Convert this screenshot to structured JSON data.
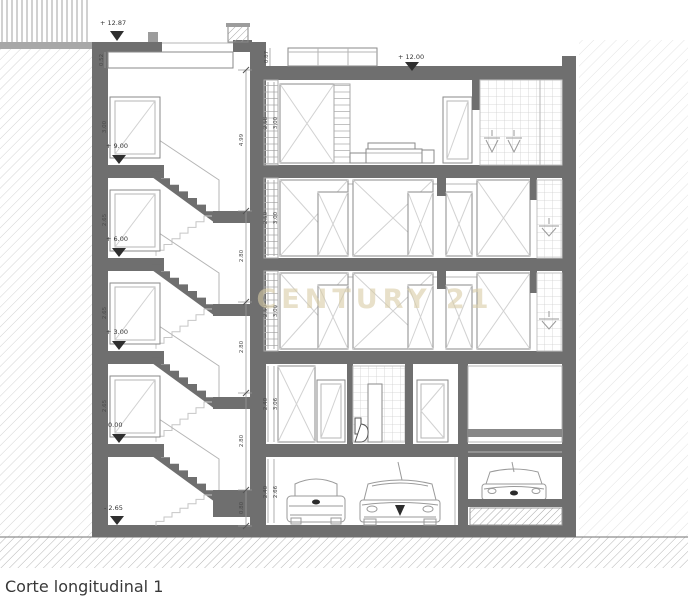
{
  "caption": "Corte longitudinal 1",
  "watermark": "CENTURY 21",
  "colors": {
    "wall": "#6f6f6f",
    "watermark": "#d9cda6",
    "hatch": "#c9c9c9",
    "text": "#383838"
  },
  "levels": {
    "tower_roof": "+ 12.87",
    "main_roof": "+ 12.00",
    "floor3": "+ 9.00",
    "floor2": "+ 6.00",
    "floor1": "+ 3.00",
    "ground": "0.00",
    "basement": "- 2.65"
  },
  "dimensions": {
    "tower_parapet": "0.52",
    "roof_parapet": "0.87",
    "stair_chain": [
      "4.99",
      "2.80",
      "2.80",
      "2.80",
      "0.80"
    ],
    "stair_doors": [
      "3.00",
      "2.65",
      "2.65",
      "2.65"
    ],
    "floors": [
      {
        "clear": "2.58",
        "total": "3.00"
      },
      {
        "clear": "2.50",
        "total": "3.00"
      },
      {
        "clear": "2.50",
        "total": "3.00"
      },
      {
        "clear": "2.40",
        "total": "3.06"
      },
      {
        "clear": "2.40",
        "total": "2.66"
      }
    ]
  }
}
